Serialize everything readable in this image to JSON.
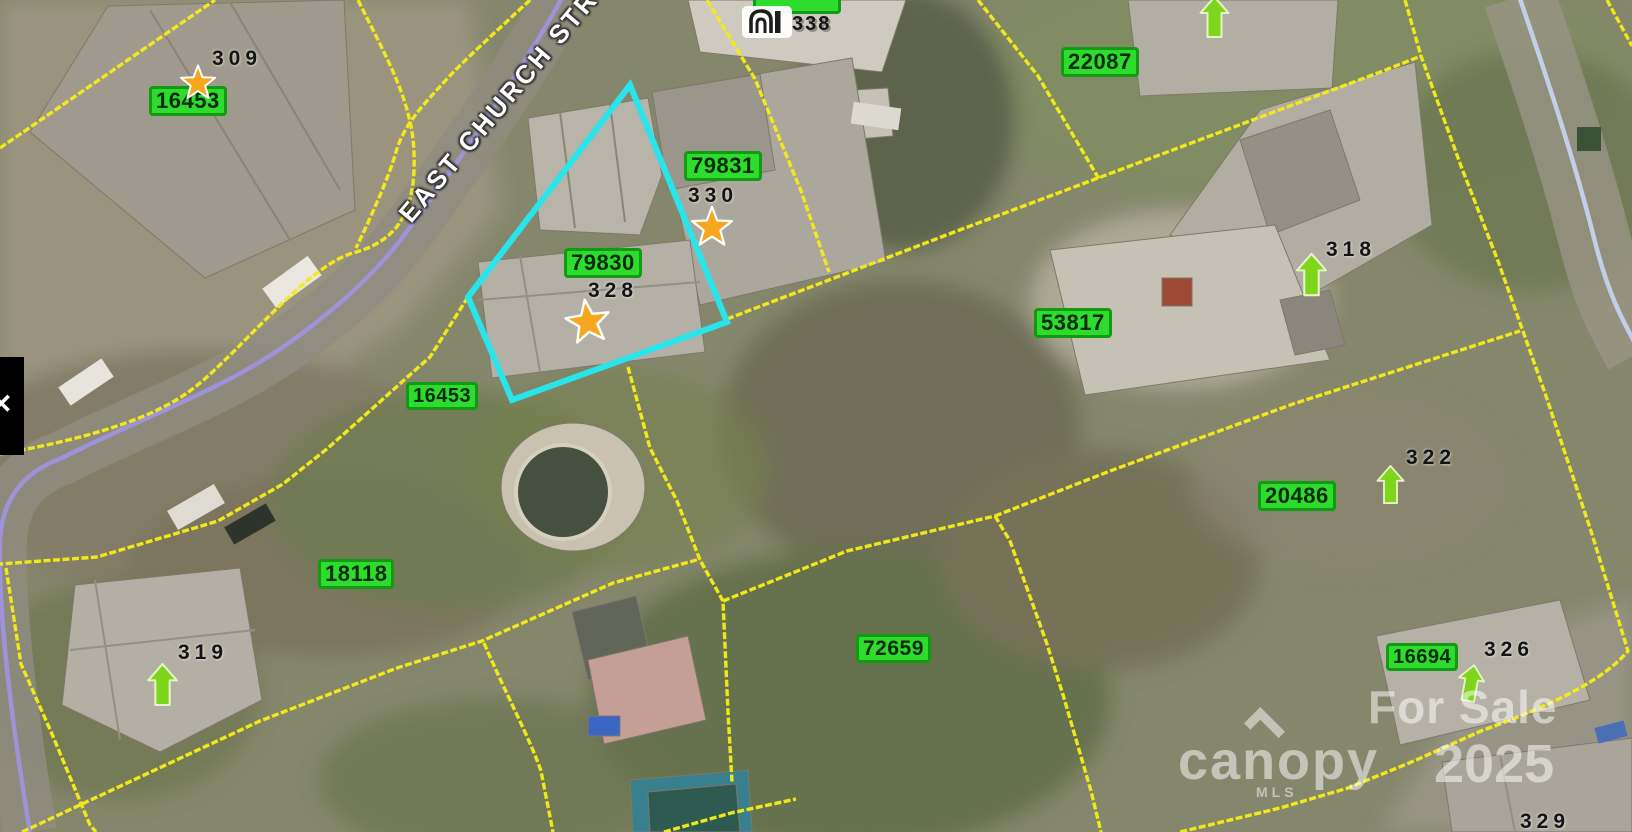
{
  "map": {
    "street_label": "EAST CHURCH STREET",
    "house_icon_number": "338",
    "icons": {
      "panel_toggle": "✕"
    },
    "colors": {
      "parcel_line": "#f4ec16",
      "selected_parcel": "#29e4ea",
      "road_centerline_purple": "#9d93d6",
      "road_centerline_blue": "#c3cfe8",
      "badge_green": "#2edc2e",
      "marker_orange": "#f6a71d",
      "arrow_lime": "#7fd41c"
    },
    "badges": [
      {
        "label": "16453"
      },
      {
        "label": "79831"
      },
      {
        "label": "79830"
      },
      {
        "label": "22087"
      },
      {
        "label": "53817"
      },
      {
        "label": "16453"
      },
      {
        "label": "18118"
      },
      {
        "label": "72659"
      },
      {
        "label": "20486"
      },
      {
        "label": "16694"
      }
    ],
    "address_labels": [
      {
        "label": "309"
      },
      {
        "label": "330"
      },
      {
        "label": "328"
      },
      {
        "label": "318"
      },
      {
        "label": "319"
      },
      {
        "label": "322"
      },
      {
        "label": "326"
      },
      {
        "label": "329"
      }
    ],
    "watermark": {
      "for_sale": "For Sale",
      "brand": "canopy",
      "mls": "MLS",
      "year": "2025"
    }
  }
}
